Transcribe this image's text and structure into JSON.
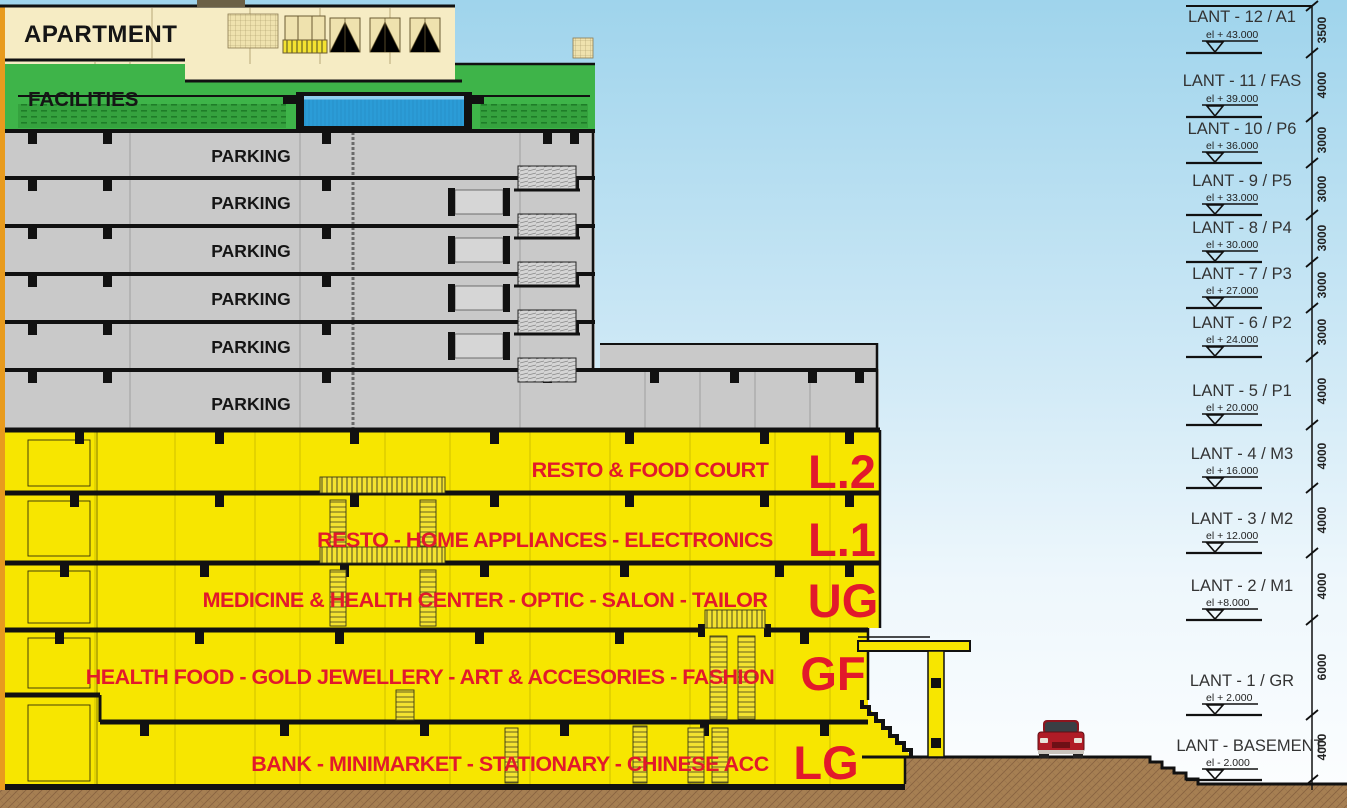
{
  "building": {
    "apartment_label": "APARTMENT",
    "facilities_label": "FACILITIES",
    "parking_label": "PARKING",
    "floors": [
      {
        "code": "L.2",
        "label": "RESTO & FOOD COURT"
      },
      {
        "code": "L.1",
        "label": "RESTO - HOME APPLIANCES - ELECTRONICS"
      },
      {
        "code": "UG",
        "label": "MEDICINE & HEALTH CENTER - OPTIC - SALON - TAILOR"
      },
      {
        "code": "GF",
        "label": "HEALTH FOOD - GOLD JEWELLERY - ART & ACCESORIES - FASHION"
      },
      {
        "code": "LG",
        "label": "BANK - MINIMARKET - STATIONARY - CHINESE ACC"
      }
    ]
  },
  "levels": [
    {
      "name": "LANT - 12 / A1",
      "elevation": "el + 43.000",
      "height_mm": "3500"
    },
    {
      "name": "LANT - 11 / FAS",
      "elevation": "el + 39.000",
      "height_mm": "4000"
    },
    {
      "name": "LANT - 10 / P6",
      "elevation": "el + 36.000",
      "height_mm": "3000"
    },
    {
      "name": "LANT - 9 / P5",
      "elevation": "el + 33.000",
      "height_mm": "3000"
    },
    {
      "name": "LANT - 8 / P4",
      "elevation": "el + 30.000",
      "height_mm": "3000"
    },
    {
      "name": "LANT - 7 / P3",
      "elevation": "el + 27.000",
      "height_mm": "3000"
    },
    {
      "name": "LANT - 6 / P2",
      "elevation": "el + 24.000",
      "height_mm": "3000"
    },
    {
      "name": "LANT - 5 / P1",
      "elevation": "el + 20.000",
      "height_mm": "4000"
    },
    {
      "name": "LANT - 4 / M3",
      "elevation": "el + 16.000",
      "height_mm": "4000"
    },
    {
      "name": "LANT - 3 / M2",
      "elevation": "el + 12.000",
      "height_mm": "4000"
    },
    {
      "name": "LANT - 2 / M1",
      "elevation": "el +8.000",
      "height_mm": "4000"
    },
    {
      "name": "LANT - 1 / GR",
      "elevation": "el + 2.000",
      "height_mm": "6000"
    },
    {
      "name": "LANT - BASEMENT",
      "elevation": "el - 2.000",
      "height_mm": "4000"
    }
  ],
  "colors": {
    "sky_top": "#9fd4ec",
    "sky_bottom": "#fdfeff",
    "apartment_cream": "#f6ecc4",
    "facilities_green": "#3eb449",
    "parking_gray": "#c9c9c9",
    "retail_yellow": "#f7e600",
    "label_red": "#e2192b",
    "ground_brown": "#a67f52",
    "pool_blue": "#2b9cd7",
    "line_black": "#111111",
    "car_red": "#b01c26"
  }
}
